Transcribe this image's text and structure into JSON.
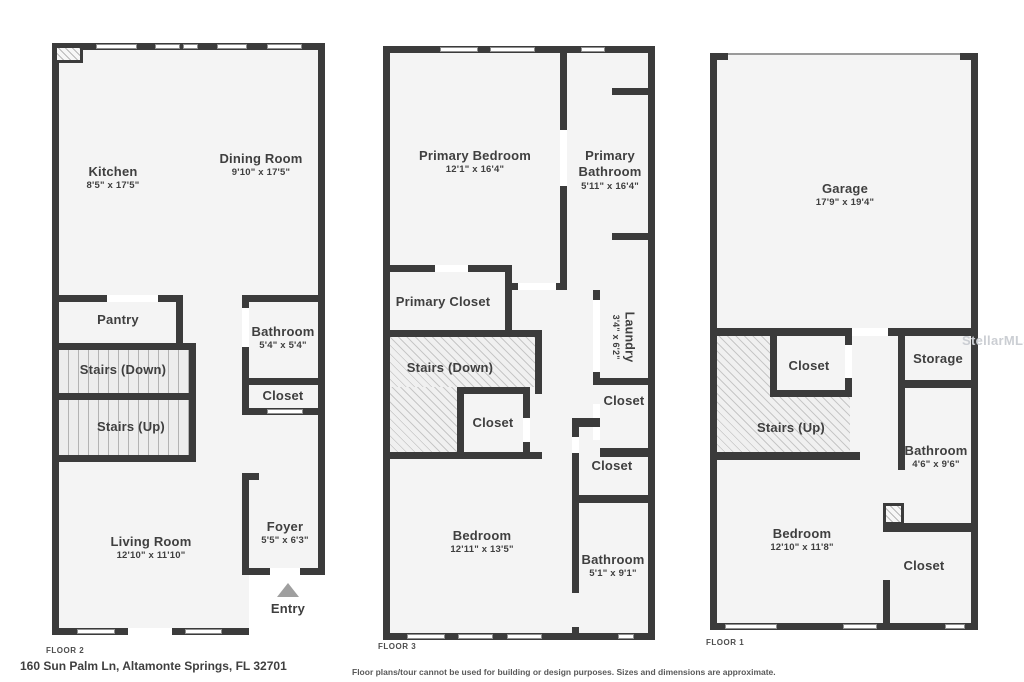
{
  "address": "160 Sun Palm Ln, Altamonte Springs, FL 32701",
  "disclaimer": "Floor plans/tour cannot be used for building or design purposes. Sizes and dimensions are approximate.",
  "watermark": "StellarMLS",
  "colors": {
    "wall": "#3b3b3b",
    "floor": "#f4f4f4",
    "text": "#3f3f3f"
  },
  "floor2": {
    "label": "FLOOR 2",
    "kitchen": {
      "name": "Kitchen",
      "dims": "8'5\" x 17'5\""
    },
    "dining": {
      "name": "Dining Room",
      "dims": "9'10\" x 17'5\""
    },
    "pantry": {
      "name": "Pantry"
    },
    "stairsDown": {
      "name": "Stairs (Down)"
    },
    "stairsUp": {
      "name": "Stairs (Up)"
    },
    "bathroom": {
      "name": "Bathroom",
      "dims": "5'4\" x 5'4\""
    },
    "closet": {
      "name": "Closet"
    },
    "living": {
      "name": "Living Room",
      "dims": "12'10\" x 11'10\""
    },
    "foyer": {
      "name": "Foyer",
      "dims": "5'5\" x 6'3\""
    },
    "entry": {
      "name": "Entry"
    }
  },
  "floor3": {
    "label": "FLOOR 3",
    "primaryBedroom": {
      "name": "Primary Bedroom",
      "dims": "12'1\" x 16'4\""
    },
    "primaryBathroom": {
      "name": "Primary Bathroom",
      "dims": "5'11\" x 16'4\""
    },
    "primaryCloset": {
      "name": "Primary Closet"
    },
    "stairsDown": {
      "name": "Stairs (Down)"
    },
    "laundry": {
      "name": "Laundry",
      "dims": "3'4\" x 6'2\""
    },
    "closetCenter": {
      "name": "Closet"
    },
    "closetRight": {
      "name": "Closet"
    },
    "closetMid": {
      "name": "Closet"
    },
    "bedroom": {
      "name": "Bedroom",
      "dims": "12'11\" x 13'5\""
    },
    "bathroom": {
      "name": "Bathroom",
      "dims": "5'1\" x 9'1\""
    }
  },
  "floor1": {
    "label": "FLOOR 1",
    "garage": {
      "name": "Garage",
      "dims": "17'9\" x 19'4\""
    },
    "closetStairs": {
      "name": "Closet"
    },
    "stairsUp": {
      "name": "Stairs (Up)"
    },
    "storage": {
      "name": "Storage"
    },
    "bathroom": {
      "name": "Bathroom",
      "dims": "4'6\" x 9'6\""
    },
    "bedroom": {
      "name": "Bedroom",
      "dims": "12'10\" x 11'8\""
    },
    "closet": {
      "name": "Closet"
    }
  }
}
